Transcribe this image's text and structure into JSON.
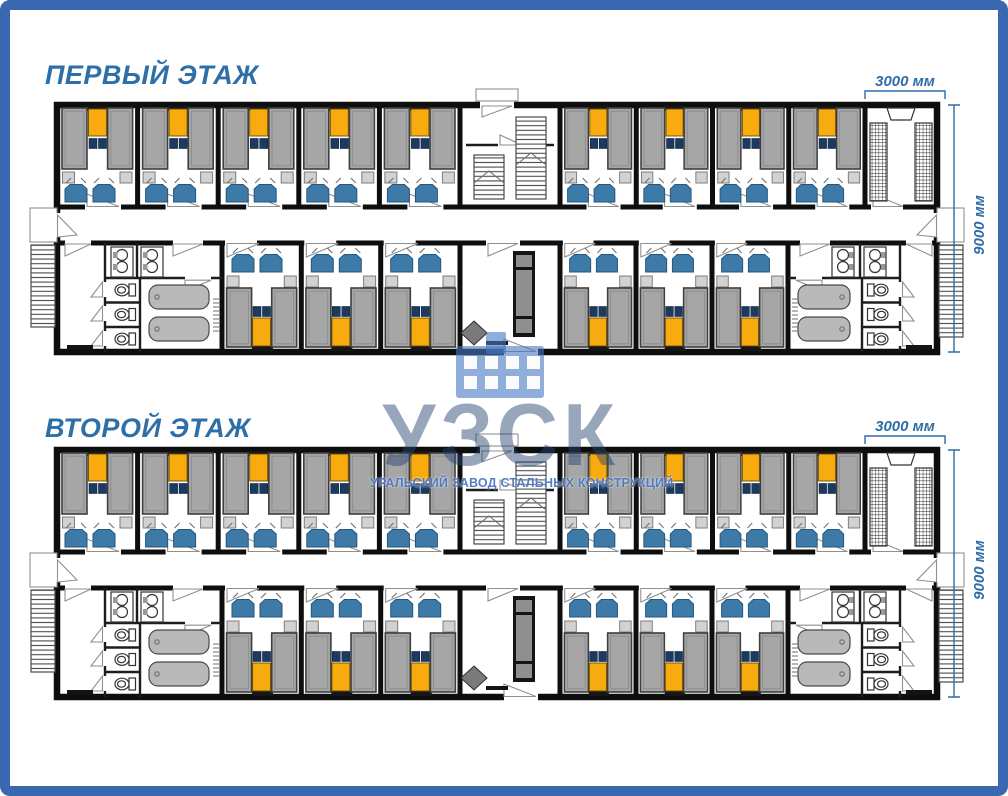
{
  "document": {
    "type": "modular-building-floor-plan-poster",
    "language": "ru"
  },
  "frame": {
    "color": "#3A68B0"
  },
  "floors": [
    {
      "title": "ПЕРВЫЙ ЭТАЖ"
    },
    {
      "title": "ВТОРОЙ ЭТАЖ"
    }
  ],
  "dimensions": {
    "module_width": "3000 мм",
    "building_depth": "9000 мм"
  },
  "watermark": {
    "logo_text": "УЗСК",
    "subtitle": "УРАЛЬСКИЙ ЗАВОД СТАЛЬНЫХ КОНСТРУКЦИЙ",
    "icon": "factory-building-icon"
  },
  "plan_summary": {
    "bedrooms_top_row": 9,
    "bedrooms_bottom_row": 6,
    "bedrooms_per_floor": 15,
    "beds_per_bedroom": 3,
    "chairs_per_bedroom": 2,
    "stairwells_per_floor": 1,
    "drying_rooms_per_floor": 1,
    "entrance_vestibules_per_floor": 1,
    "sanitary_blocks_per_floor": 2,
    "toilets_per_sanitary_block": 3,
    "showers_per_sanitary_block": 2,
    "sinks_per_sanitary_block": 4,
    "external_staircases_per_floor": 2
  },
  "colors": {
    "frame_blue": "#3A68B0",
    "title_blue": "#2F6FA8",
    "dimension_blue": "#2E6DA6",
    "wall_black": "#0E0E0E",
    "bed_gray": "#A6A6A6",
    "blanket_yellow": "#F7AB0F",
    "pillow_navy": "#1C3A60",
    "chair_blue": "#3E7AA8",
    "fixture_gray": "#B9B9B9",
    "watermark_blue": "rgba(56,104,188,0.85)"
  }
}
